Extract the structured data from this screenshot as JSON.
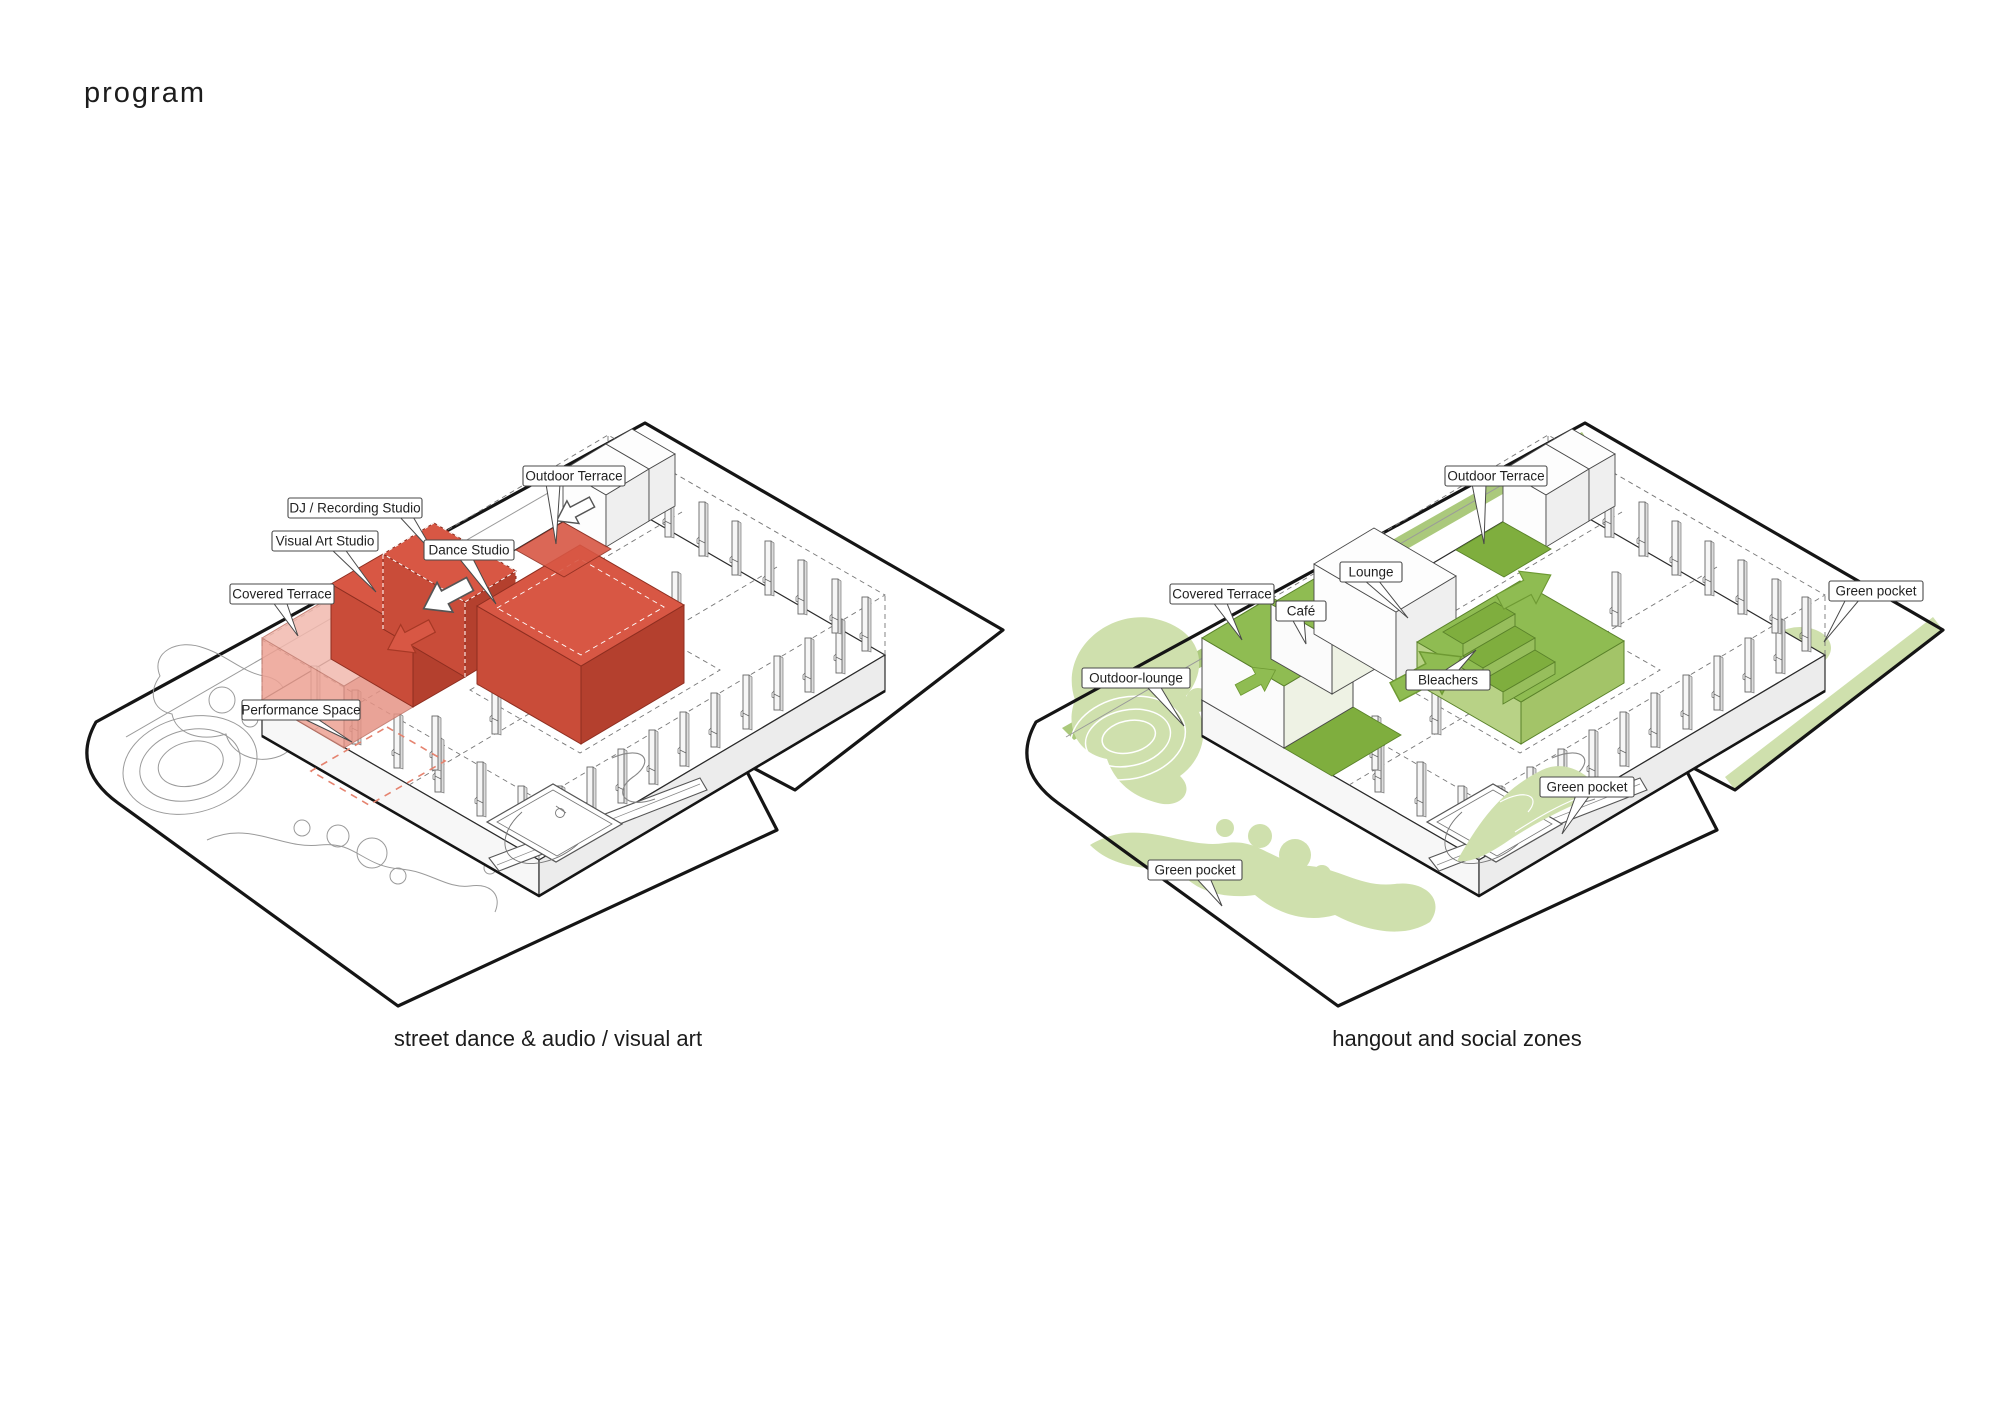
{
  "title": "program",
  "colors": {
    "red_accent": "#d85744",
    "red_side": "#c0452f",
    "red_light": "#efaca0",
    "green_accent": "#8fbc52",
    "green_dark": "#7fae3e",
    "green_band": "#abc97c",
    "green_pale": "#cfe0ad",
    "line": "#1b1b1b"
  },
  "left_panel": {
    "caption": "street dance & audio / visual art",
    "labels": {
      "outdoor_terrace": "Outdoor Terrace",
      "dj_recording_studio": "DJ / Recording Studio",
      "visual_art_studio": "Visual Art Studio",
      "dance_studio": "Dance Studio",
      "covered_terrace": "Covered Terrace",
      "performance_space": "Performance Space"
    }
  },
  "right_panel": {
    "caption": "hangout and social zones",
    "labels": {
      "outdoor_terrace": "Outdoor Terrace",
      "covered_terrace": "Covered Terrace",
      "cafe": "Café",
      "lounge": "Lounge",
      "bleachers": "Bleachers",
      "outdoor_lounge": "Outdoor-lounge",
      "green_pocket_right": "Green pocket",
      "green_pocket_mid": "Green pocket",
      "green_pocket_bottom": "Green pocket"
    }
  }
}
